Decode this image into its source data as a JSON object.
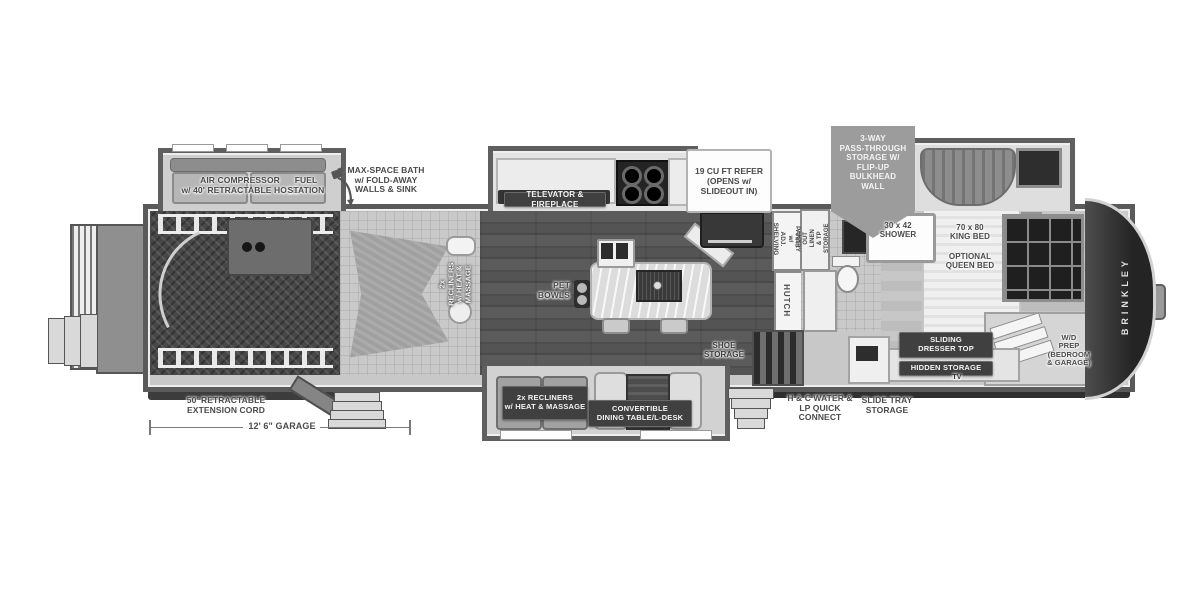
{
  "brand": "BRINKLEY",
  "colors": {
    "background": "#ffffff",
    "wall": "#5a5a5a",
    "badge_dark": "#404040",
    "badge_gray": "#9c9c9c",
    "label_text": "#4a4a4a",
    "floor_wood": "#8f8f8f",
    "floor_garage": "#454545",
    "front_cap": "#2e2e2e"
  },
  "callouts": {
    "air_compressor": "AIR COMPRESSOR\nw/ 40' RETRACTABLE HOSE",
    "fuel_station": "FUEL\nSTATION",
    "max_space_bath": "MAX-SPACE BATH\nw/ FOLD-AWAY\nWALLS & SINK",
    "televator": "TELEVATOR & FIREPLACE",
    "refer": "19 CU FT REFER\n(OPENS w/\nSLIDEOUT IN)",
    "pass_through": "3-WAY\nPASS-THROUGH\nSTORAGE W/\nFLIP-UP\nBULKHEAD\nWALL",
    "pantry": "PANTRY w/\nADJ. SHELVING",
    "hutch": "HUTCH",
    "linen": "PULL-OUT LINEN\n& TP STORAGE",
    "shower": "30 x 42\nSHOWER",
    "king_bed": "70 x 80\nKING BED",
    "queen_bed": "OPTIONAL\nQUEEN BED",
    "pet_bowls": "PET\nBOWLS",
    "recliners_garage": "2x RECLINERS\nw/ HEAT & MASSAGE",
    "recliners_living": "2x RECLINERS\nw/ HEAT & MASSAGE",
    "dining": "CONVERTIBLE\nDINING TABLE/L-DESK",
    "shoe_storage": "SHOE\nSTORAGE",
    "sliding_dresser": "SLIDING\nDRESSER TOP",
    "hidden_storage": "HIDDEN STORAGE",
    "tv": "TV",
    "wd_prep": "W/D\nPREP\n(BEDROOM\n& GARAGE)",
    "hc_water": "H & C WATER &\nLP QUICK CONNECT",
    "slide_tray": "SLIDE TRAY\nSTORAGE",
    "extension_cord": "50' RETRACTABLE\nEXTENSION CORD",
    "garage_dimension": "12' 6\" GARAGE"
  }
}
